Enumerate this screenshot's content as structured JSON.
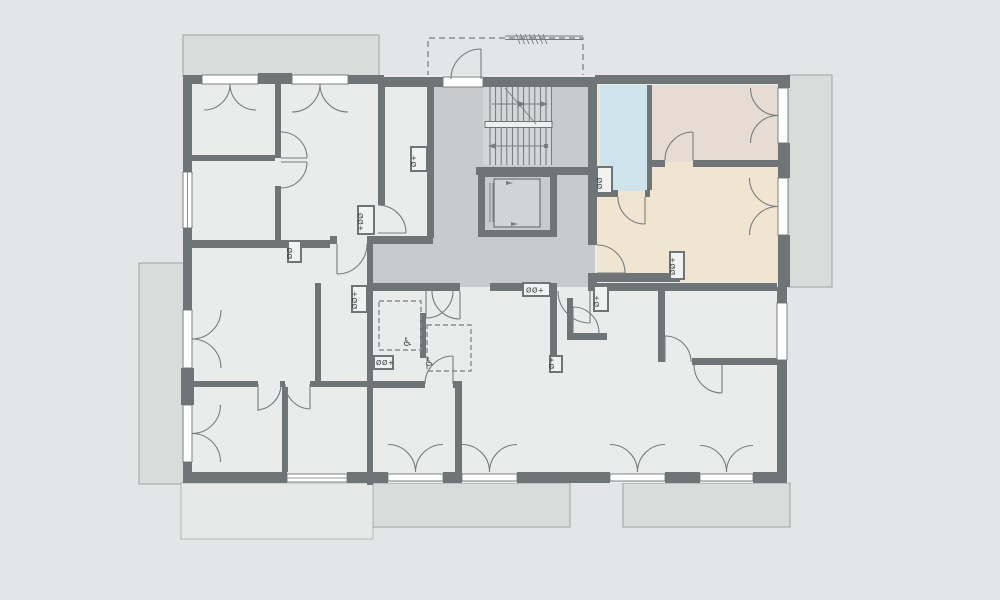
{
  "title": "Apartment building floor plan",
  "colors": {
    "background": "#e3e5e6",
    "floor": "#eaecec",
    "terrace": "#e7e9e8",
    "wall": "#6f7577",
    "line": "#777d7f",
    "core": "#c7cbcb",
    "stair": "#d4d7d7",
    "balcony": "#d8dcdb",
    "balcony_border": "#9ea4a4",
    "unit_living": "#f0e5d0",
    "unit_bedroom": "#e7dcd4",
    "unit_bath": "#cfe3ed",
    "white": "#ffffff"
  },
  "symbols": {
    "wheelchair": "♿",
    "shaft_boxes": [
      {
        "text": "Ø+"
      },
      {
        "text": "+ØØ"
      },
      {
        "text": "ØØ"
      },
      {
        "text": "ØØ+"
      },
      {
        "text": "ØØ+"
      },
      {
        "text": "ØØ+"
      },
      {
        "text": "Ø+"
      },
      {
        "text": "ØØ"
      },
      {
        "text": "ØØ+"
      },
      {
        "text": "Ø+"
      }
    ]
  }
}
